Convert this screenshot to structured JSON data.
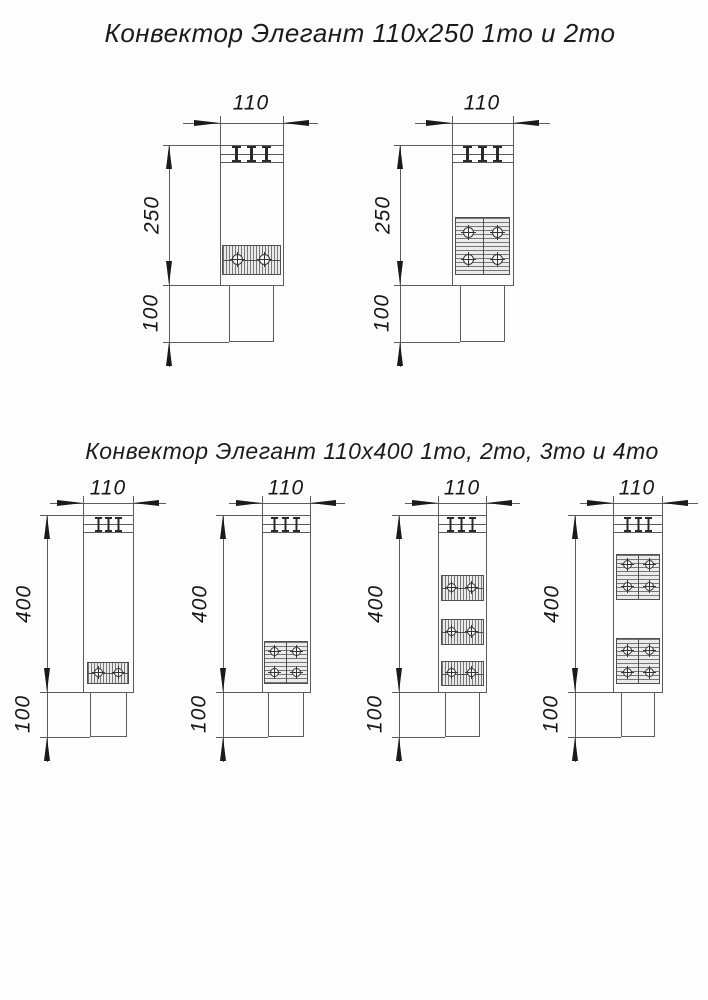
{
  "sections": [
    {
      "title": "Конвектор Элегант 110х250 1то и 2то"
    },
    {
      "title": "Конвектор Элегант 110х400 1то, 2то, 3то и 4то"
    }
  ],
  "diagrams": [
    {
      "variant": "1то",
      "size": "110x250",
      "width_label": "110",
      "height_label": "250",
      "base_label": "100",
      "exchanger_blocks": 1,
      "tubes_shown": 2
    },
    {
      "variant": "2то",
      "size": "110x250",
      "width_label": "110",
      "height_label": "250",
      "base_label": "100",
      "exchanger_blocks": 1,
      "tubes_shown": 4
    },
    {
      "variant": "1то",
      "size": "110x400",
      "width_label": "110",
      "height_label": "400",
      "base_label": "100",
      "exchanger_blocks": 1,
      "tubes_shown": 2
    },
    {
      "variant": "2то",
      "size": "110x400",
      "width_label": "110",
      "height_label": "400",
      "base_label": "100",
      "exchanger_blocks": 1,
      "tubes_shown": 4
    },
    {
      "variant": "3то",
      "size": "110x400",
      "width_label": "110",
      "height_label": "400",
      "base_label": "100",
      "exchanger_blocks": 3,
      "tubes_shown": 6
    },
    {
      "variant": "4то",
      "size": "110x400",
      "width_label": "110",
      "height_label": "400",
      "base_label": "100",
      "exchanger_blocks": 2,
      "tubes_shown": 8
    }
  ]
}
